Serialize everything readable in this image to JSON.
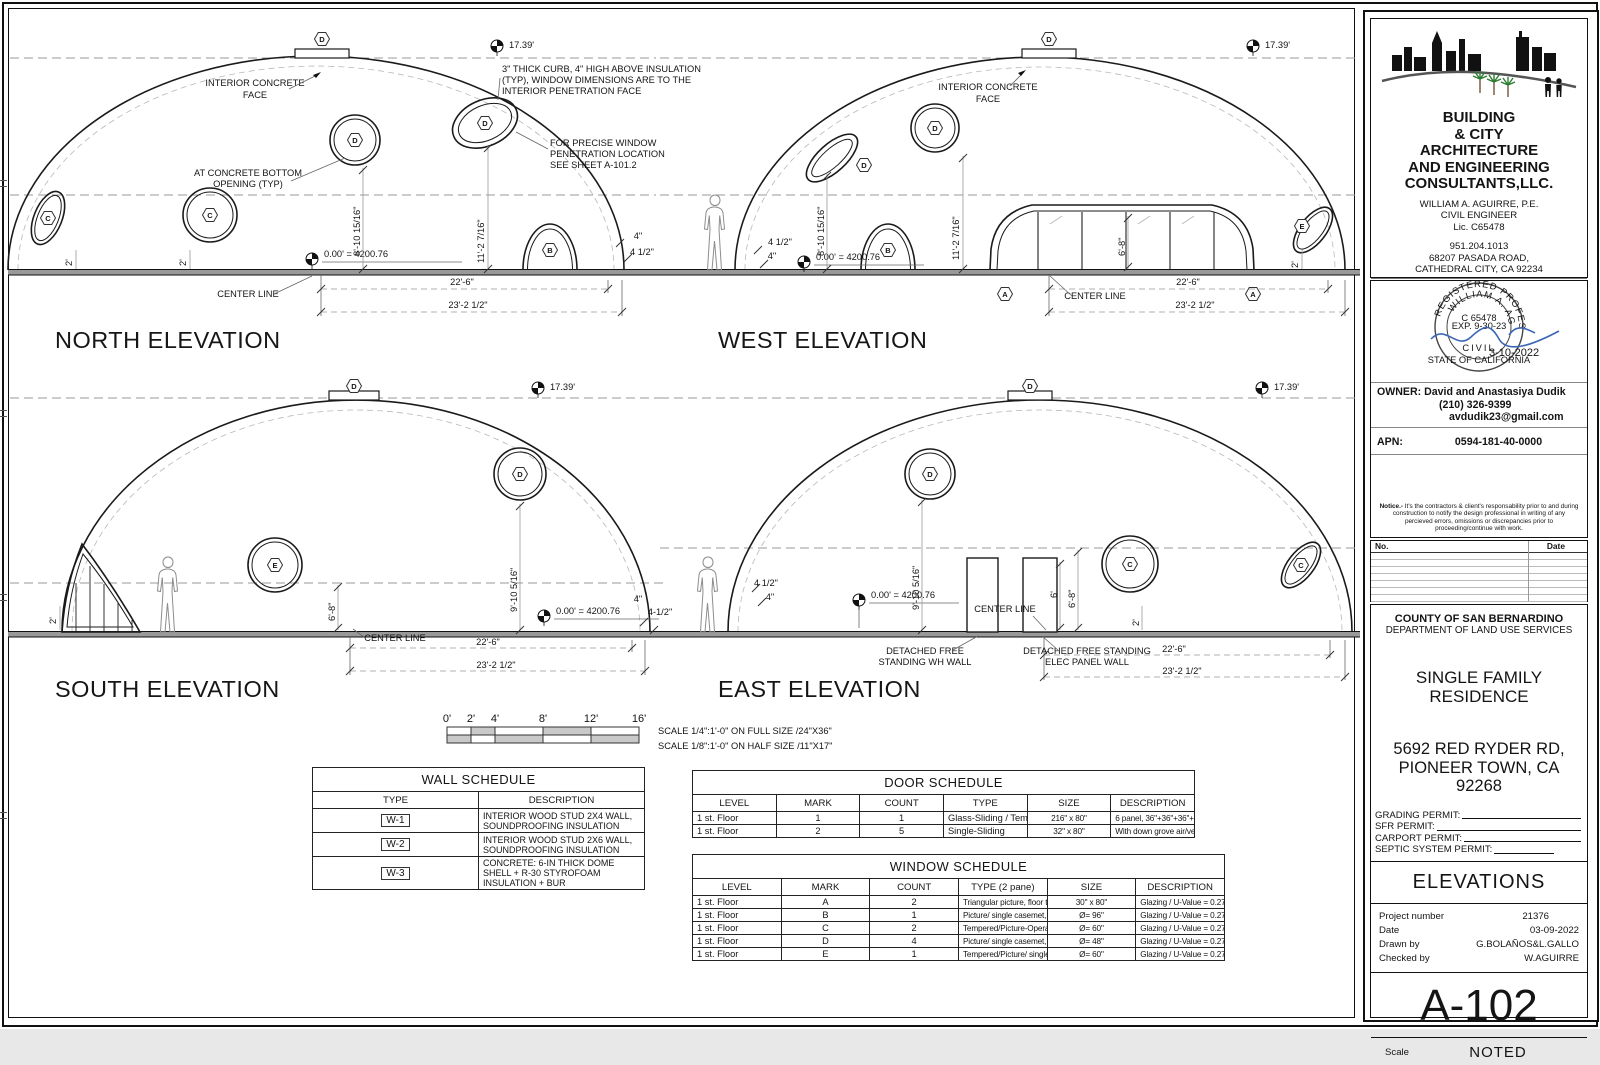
{
  "titles": {
    "north": "NORTH ELEVATION",
    "west": "WEST ELEVATION",
    "south": "SOUTH ELEVATION",
    "east": "EAST ELEVATION"
  },
  "ann": {
    "center_line": "CENTER LINE",
    "d226": "22'-6\"",
    "d232": "23'-2 1/2\"",
    "datum": "0.00' = 4200.76",
    "apex": "17.39'",
    "d810": "8'-10 15/16\"",
    "d112": "11'-2 7/16\"",
    "d910": "9'-10 5/16\"",
    "d68": "6'-8\"",
    "d6": "6'",
    "d4": "4\"",
    "d412": "4 1/2\"",
    "d412s": "4-1/2\"",
    "d2": "2'",
    "icf1": "INTERIOR CONCRETE",
    "icf2": "FACE",
    "curb1": "3\" THICK CURB, 4\" HIGH ABOVE INSULATION",
    "curb2": "(TYP), WINDOW DIMENSIONS ARE TO THE",
    "curb3": "INTERIOR PENETRATION FACE",
    "pen1": "FOR PRECISE WINDOW",
    "pen2": "PENETRATION LOCATION",
    "pen3": "SEE SHEET A-101.2",
    "bot1": "AT CONCRETE BOTTOM",
    "bot2": "OPENING (TYP)",
    "wh1": "DETACHED FREE",
    "wh2": "STANDING WH WALL",
    "elec1": "DETACHED FREE STANDING",
    "elec2": "ELEC PANEL WALL"
  },
  "markers": {
    "a": "A",
    "b": "B",
    "c": "C",
    "d": "D",
    "e": "E"
  },
  "scale_bar": {
    "ticks": [
      "0'",
      "2'",
      "4'",
      "8'",
      "12'",
      "16'"
    ],
    "note1": "SCALE 1/4\":1'-0\" ON FULL SIZE /24\"X36\"",
    "note2": "SCALE 1/8\":1'-0\" ON HALF SIZE /11\"X17\""
  },
  "wall_schedule": {
    "title": "WALL SCHEDULE",
    "headers": [
      "TYPE",
      "DESCRIPTION"
    ],
    "rows": [
      {
        "type": "W-1",
        "desc": "INTERIOR WOOD STUD 2X4 WALL, SOUNDPROOFING INSULATION"
      },
      {
        "type": "W-2",
        "desc": "INTERIOR WOOD STUD 2X6 WALL, SOUNDPROOFING INSULATION"
      },
      {
        "type": "W-3",
        "desc": "CONCRETE: 6-IN THICK DOME SHELL + R-30 STYROFOAM INSULATION + BUR"
      }
    ]
  },
  "door_schedule": {
    "title": "DOOR SCHEDULE",
    "headers": [
      "LEVEL",
      "MARK",
      "COUNT",
      "TYPE",
      "SIZE",
      "DESCRIPTION"
    ],
    "rows": [
      [
        "1 st. Floor",
        "1",
        "1",
        "Glass-Sliding / Tempered",
        "216\" x 80\"",
        "6 panel, 36\"+36\"+36\"+36\"+36\"+36\""
      ],
      [
        "1 st. Floor",
        "2",
        "5",
        "Single-Sliding",
        "32\" x 80\"",
        "With down grove air/vent, bathroom & bedroom door."
      ]
    ]
  },
  "window_schedule": {
    "title": "WINDOW SCHEDULE",
    "headers": [
      "LEVEL",
      "MARK",
      "COUNT",
      "TYPE (2 pane)",
      "SIZE",
      "DESCRIPTION"
    ],
    "rows": [
      [
        "1 st. Floor",
        "A",
        "2",
        "Triangular picture, floor to ceiling, vinyl",
        "30\" x 80\"",
        "Glazing / U-Value = 0.27  / SHGC = 0.35"
      ],
      [
        "1 st. Floor",
        "B",
        "1",
        "Picture/ single casemet, vinyl",
        "Ø= 96\"",
        "Glazing / U-Value = 0.27  / SHGC = 0.35"
      ],
      [
        "1 st. Floor",
        "C",
        "2",
        "Tempered/Picture-Operable/ single casemet, vinyl",
        "Ø= 60\"",
        "Glazing / U-Value = 0.27  / SHGC = 0.35"
      ],
      [
        "1 st. Floor",
        "D",
        "4",
        "Picture/ single casemet, vinyl",
        "Ø= 48\"",
        "Glazing / U-Value = 0.27  / SHGC = 0.35"
      ],
      [
        "1 st. Floor",
        "E",
        "1",
        "Tempered/Picture/ single casemet, vinyl",
        "Ø= 60\"",
        "Glazing / U-Value = 0.27  / SHGC = 0.35"
      ]
    ]
  },
  "firm": {
    "l1": "BUILDING",
    "l2": "& CITY",
    "l3": "ARCHITECTURE",
    "l4": "AND ENGINEERING",
    "l5": "CONSULTANTS,LLC.",
    "person": "WILLIAM A. AGUIRRE, P.E.",
    "role": "CIVIL ENGINEER",
    "lic": "Lic. C65478",
    "phone": "951.204.1013",
    "addr1": "68207 PASADA ROAD,",
    "addr2": "CATHEDRAL CITY, CA 92234",
    "web": "WWW.ARCH-ENG-CONSULTANTS.COM",
    "email": "waguirre@arch-eng-consultants.com",
    "skype": "SKYPE: bill-a-2011"
  },
  "stamp": {
    "ring_top": "REGISTERED PROFESSIONAL ENGINEER",
    "ring_name": "WILLIAM A. AGUIRRE",
    "lic": "C 65478",
    "exp": "EXP. 9-30-23",
    "civil": "CIVIL",
    "state": "STATE OF CALIFORNIA",
    "date": "3-10-2022"
  },
  "owner": {
    "label": "OWNER:",
    "name": "David and Anastasiya Dudik",
    "phone": "(210) 326-9399",
    "email": "avdudik23@gmail.com"
  },
  "apn": {
    "label": "APN:",
    "value": "0594-181-40-0000"
  },
  "notice_label": "Notice.-",
  "notice_body": " It's the contractors & client's responsability prior to and during construction to notify the design professional in writing of any percieved errors, omissions or discrepancies prior to proceeding/continue with work.",
  "revisions": {
    "no": "No.",
    "date": "Date"
  },
  "agency": {
    "l1": "COUNTY OF SAN BERNARDINO",
    "l2": "DEPARTMENT OF LAND USE SERVICES"
  },
  "project": {
    "t1": "SINGLE FAMILY",
    "t2": "RESIDENCE",
    "a1": "5692 RED RYDER RD,",
    "a2": "PIONEER TOWN, CA",
    "a3": "92268"
  },
  "permits": [
    "GRADING PERMIT:",
    "SFR PERMIT:",
    "CARPORT PERMIT:",
    "SEPTIC SYSTEM PERMIT:"
  ],
  "sheet": {
    "title": "ELEVATIONS",
    "num_label": "Project number",
    "num": "21376",
    "date_label": "Date",
    "date": "03-09-2022",
    "drawn_label": "Drawn by",
    "drawn": "G.BOLAÑOS&L.GALLO",
    "checked_label": "Checked by",
    "checked": "W.AGUIRRE",
    "no": "A-102",
    "scale_label": "Scale",
    "scale": "NOTED"
  }
}
